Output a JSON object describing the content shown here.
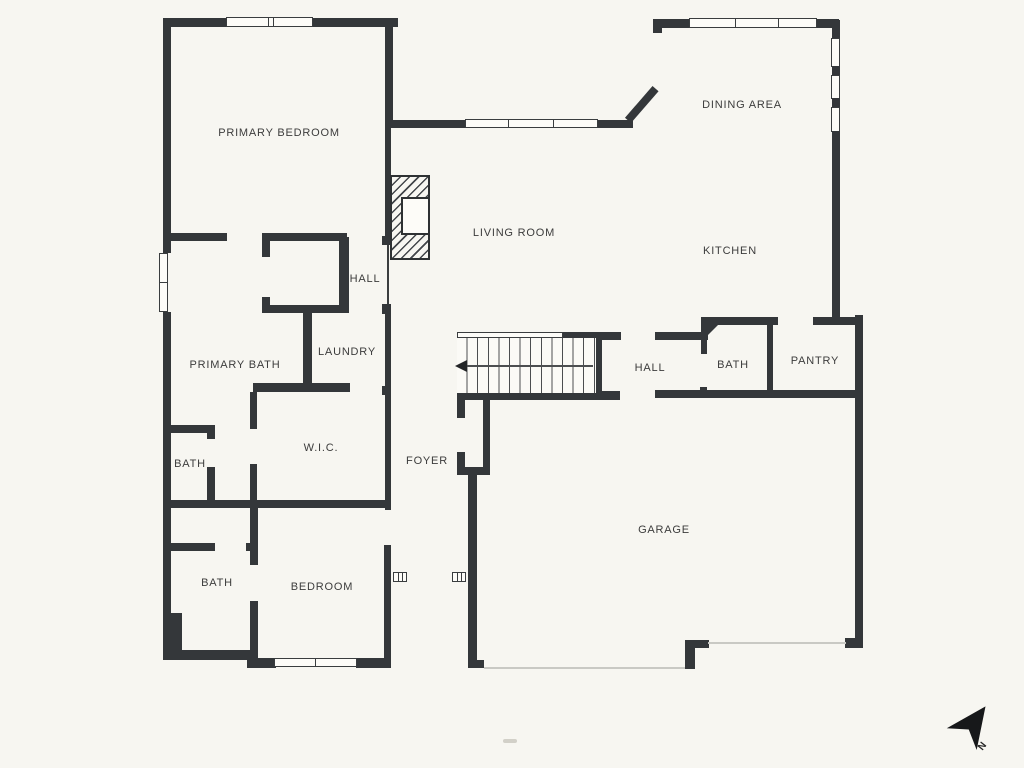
{
  "floorplan": {
    "rooms": [
      {
        "id": "primary-bedroom",
        "label": "PRIMARY BEDROOM"
      },
      {
        "id": "dining-area",
        "label": "DINING AREA"
      },
      {
        "id": "living-room",
        "label": "LIVING ROOM"
      },
      {
        "id": "kitchen",
        "label": "KITCHEN"
      },
      {
        "id": "hall-primary",
        "label": "HALL"
      },
      {
        "id": "primary-bath",
        "label": "PRIMARY BATH"
      },
      {
        "id": "laundry",
        "label": "LAUNDRY"
      },
      {
        "id": "hall-main",
        "label": "HALL"
      },
      {
        "id": "bath-main",
        "label": "BATH"
      },
      {
        "id": "pantry",
        "label": "PANTRY"
      },
      {
        "id": "wic",
        "label": "W.I.C."
      },
      {
        "id": "foyer",
        "label": "FOYER"
      },
      {
        "id": "bath-primary-wc",
        "label": "BATH"
      },
      {
        "id": "bath-guest",
        "label": "BATH"
      },
      {
        "id": "bedroom",
        "label": "BEDROOM"
      },
      {
        "id": "garage",
        "label": "GARAGE"
      }
    ],
    "compass": {
      "label": "N"
    },
    "colors": {
      "wall": "#34373a",
      "background": "#f7f6f1",
      "window_fill": "#fdfcf8",
      "garage_door_line": "#c9c9c4"
    },
    "features": [
      "fireplace",
      "staircase",
      "north-arrow"
    ]
  }
}
